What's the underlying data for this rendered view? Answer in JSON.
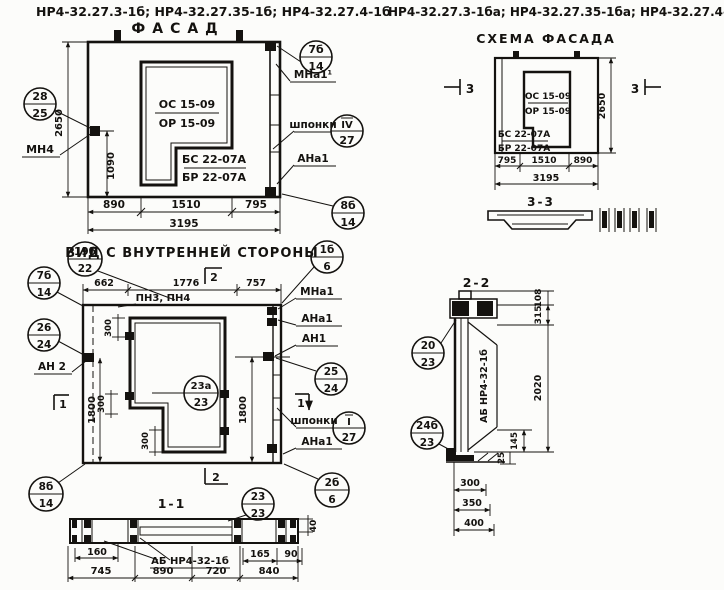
{
  "headers": {
    "left": "НР4-32.27.3-1б; НР4-32.27.35-1б; НР4-32.27.4-1б",
    "right": "НР4-32.27.3-1ба; НР4-32.27.35-1ба; НР4-32.27.4-1ба"
  },
  "facade": {
    "title": "ФАСАД",
    "dims": {
      "height": "2650",
      "anchor_height": "1090",
      "w1": "890",
      "w2": "1510",
      "w3": "795",
      "total": "3195"
    },
    "window_marks": {
      "top": "ОС 15-09",
      "bottom": "ОР 15-09"
    },
    "panel_marks": {
      "top": "БС 22-07А",
      "bottom": "БР 22-07А"
    },
    "labels": {
      "mn4": "МН4",
      "mna1": "МНа1¹",
      "shponki": "шпонки",
      "ana1": "АНа1"
    },
    "callouts": {
      "c28": {
        "top": "28",
        "bottom": "25"
      },
      "c7b": {
        "top": "7б",
        "bottom": "14"
      },
      "c4r": {
        "top": "ІV",
        "bottom": "27"
      },
      "c8b": {
        "top": "8б",
        "bottom": "14"
      }
    }
  },
  "scheme": {
    "title": "СХЕМА ФАСАДА",
    "section_mark": "3",
    "section_title": "3-3",
    "dims": {
      "height": "2650",
      "w1": "795",
      "w2": "1510",
      "w3": "890",
      "total": "3195"
    },
    "window_marks": {
      "top": "ОС 15-09",
      "bottom": "ОР 15-09"
    },
    "panel_marks": {
      "top": "БС 22-07А",
      "bottom": "БР 22-07А"
    }
  },
  "inner_view": {
    "title": "ВИД С ВНУТРЕННЕЙ СТОРОНЫ",
    "dims": {
      "w1": "662",
      "w2": "1776",
      "w3": "757",
      "d1800": "1800",
      "d300": "300"
    },
    "labels": {
      "pn": "ПН3, ПН4",
      "mna1": "МНа1",
      "ana1_top": "АНа1",
      "an1": "АН1",
      "an2": "АН 2",
      "shponki": "шпонки",
      "ana1_bottom": "АНа1"
    },
    "section_marks": {
      "s1": "1",
      "s2": "2"
    },
    "callouts": {
      "c19": {
        "top": "19б",
        "bottom": "22"
      },
      "c7": {
        "top": "7б",
        "bottom": "14"
      },
      "c26": {
        "top": "26",
        "bottom": "24"
      },
      "c8": {
        "top": "8б",
        "bottom": "14"
      },
      "c1b": {
        "top": "1б",
        "bottom": "6"
      },
      "c25": {
        "top": "25",
        "bottom": "24"
      },
      "c23a": {
        "top": "23а",
        "bottom": "23"
      },
      "cI": {
        "top": "І",
        "bottom": "27"
      },
      "c2b": {
        "top": "2б",
        "bottom": "6"
      }
    }
  },
  "section11": {
    "title": "1-1",
    "label": "АБ НР4-32-1б",
    "dims": {
      "d160": "160",
      "d40": "40",
      "d165": "165",
      "d90": "90",
      "w1": "745",
      "w2": "890",
      "w3": "720",
      "w4": "840"
    },
    "callout": {
      "top": "23",
      "bottom": "23"
    }
  },
  "section22": {
    "title": "2-2",
    "label": "АБ НР4-32-1б",
    "dims": {
      "d108": "108",
      "d315": "315",
      "d2020": "2020",
      "d145": "145",
      "d25": "25",
      "d300": "300",
      "d350": "350",
      "d400": "400"
    },
    "callouts": {
      "c20": {
        "top": "20",
        "bottom": "23"
      },
      "c24": {
        "top": "24б",
        "bottom": "23"
      }
    }
  }
}
